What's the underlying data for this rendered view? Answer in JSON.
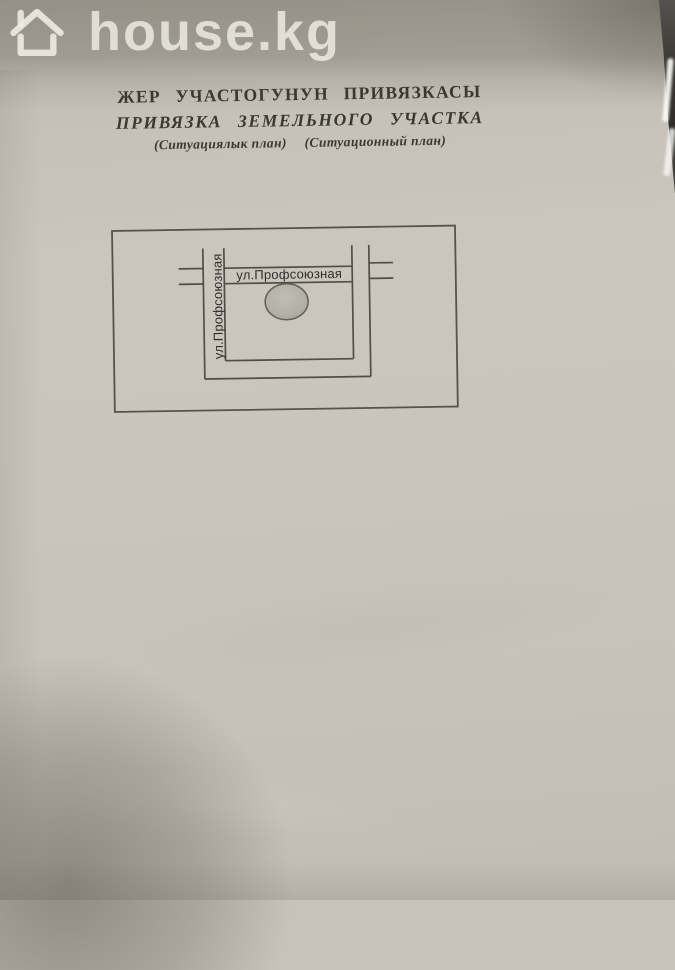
{
  "watermark": {
    "logo_text": "house.kg"
  },
  "document": {
    "title_kg": "ЖЕР УЧАСТОГУНУН ПРИВЯЗКАСЫ",
    "title_ru": "ПРИВЯЗКА ЗЕМЕЛЬНОГО УЧАСТКА",
    "subtitle_kg": "(Ситуациялык план)",
    "subtitle_ru": "(Ситуационный план)"
  },
  "diagram": {
    "horizontal_street_label": "ул.Профсоюзная",
    "vertical_street_label": "ул.Профсоюзная"
  },
  "colors": {
    "paper": "#c8c4bb",
    "top_band": "#a9a59b",
    "ink_title": "#3a3833",
    "plan_line": "#504e48",
    "plot_fill": "#b4b1a9",
    "watermark_white": "#efede6",
    "table_dark": "#2d2c29"
  }
}
